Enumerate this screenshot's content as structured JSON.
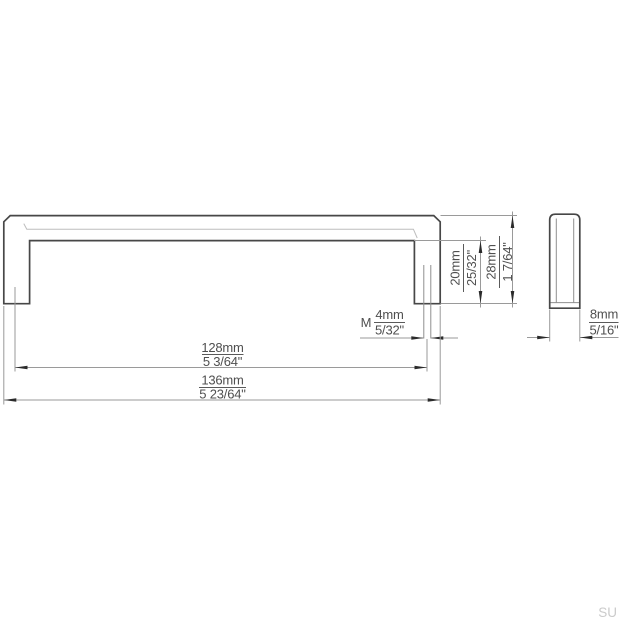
{
  "drawing": {
    "dims": {
      "hole_spacing": {
        "mm": "128mm",
        "inch": "5 3/64\""
      },
      "total_length": {
        "mm": "136mm",
        "inch": "5 23/64\""
      },
      "clearance": {
        "mm": "20mm",
        "inch": "25/32\""
      },
      "total_height": {
        "mm": "28mm",
        "inch": "1 7/64\""
      },
      "thread": {
        "prefix": "M",
        "mm": "4mm",
        "inch": "5/32\""
      },
      "depth": {
        "mm": "8mm",
        "inch": "5/16\""
      }
    },
    "watermark": "SU"
  }
}
